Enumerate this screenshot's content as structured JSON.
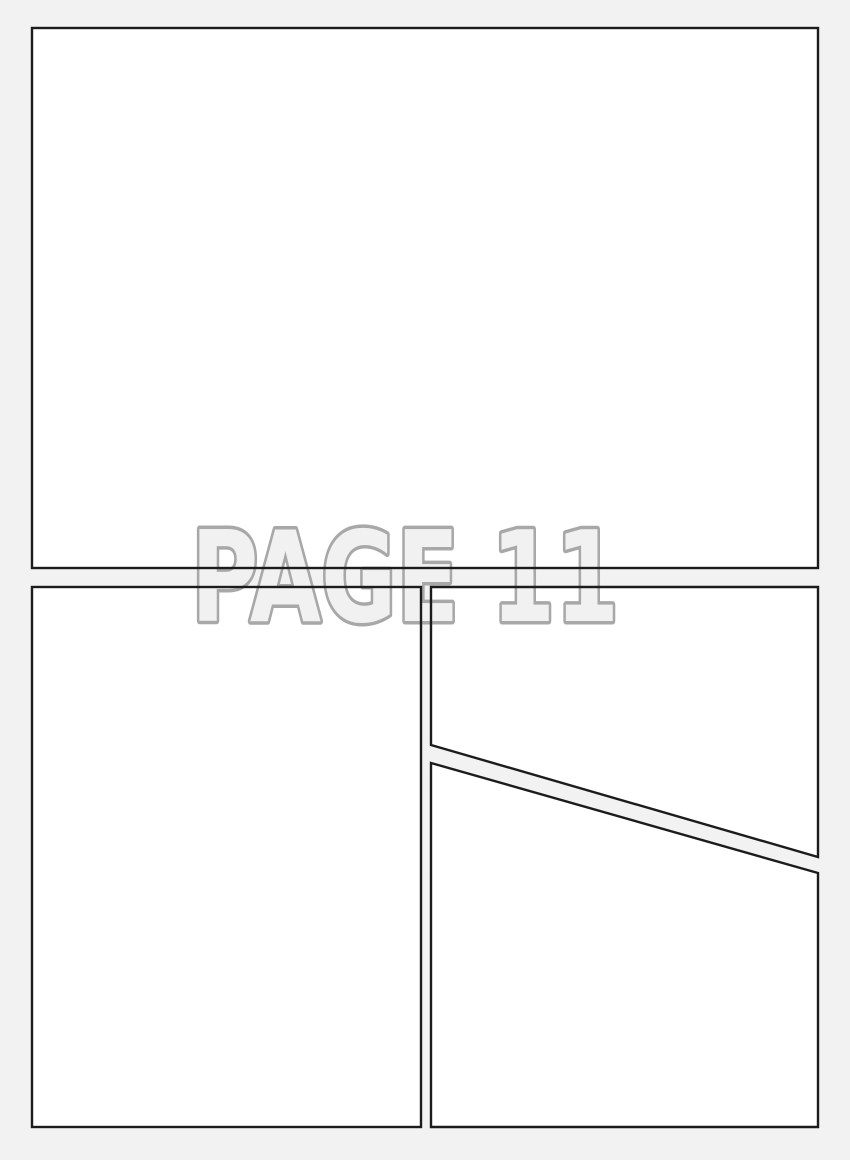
{
  "title": "PAGE 11",
  "colors": {
    "background": "#f2f2f2",
    "panel_fill": "#ffffff",
    "panel_border": "#1c1c1c",
    "title_fill": "#f1f1f1",
    "title_outline": "#a8a8a8"
  }
}
